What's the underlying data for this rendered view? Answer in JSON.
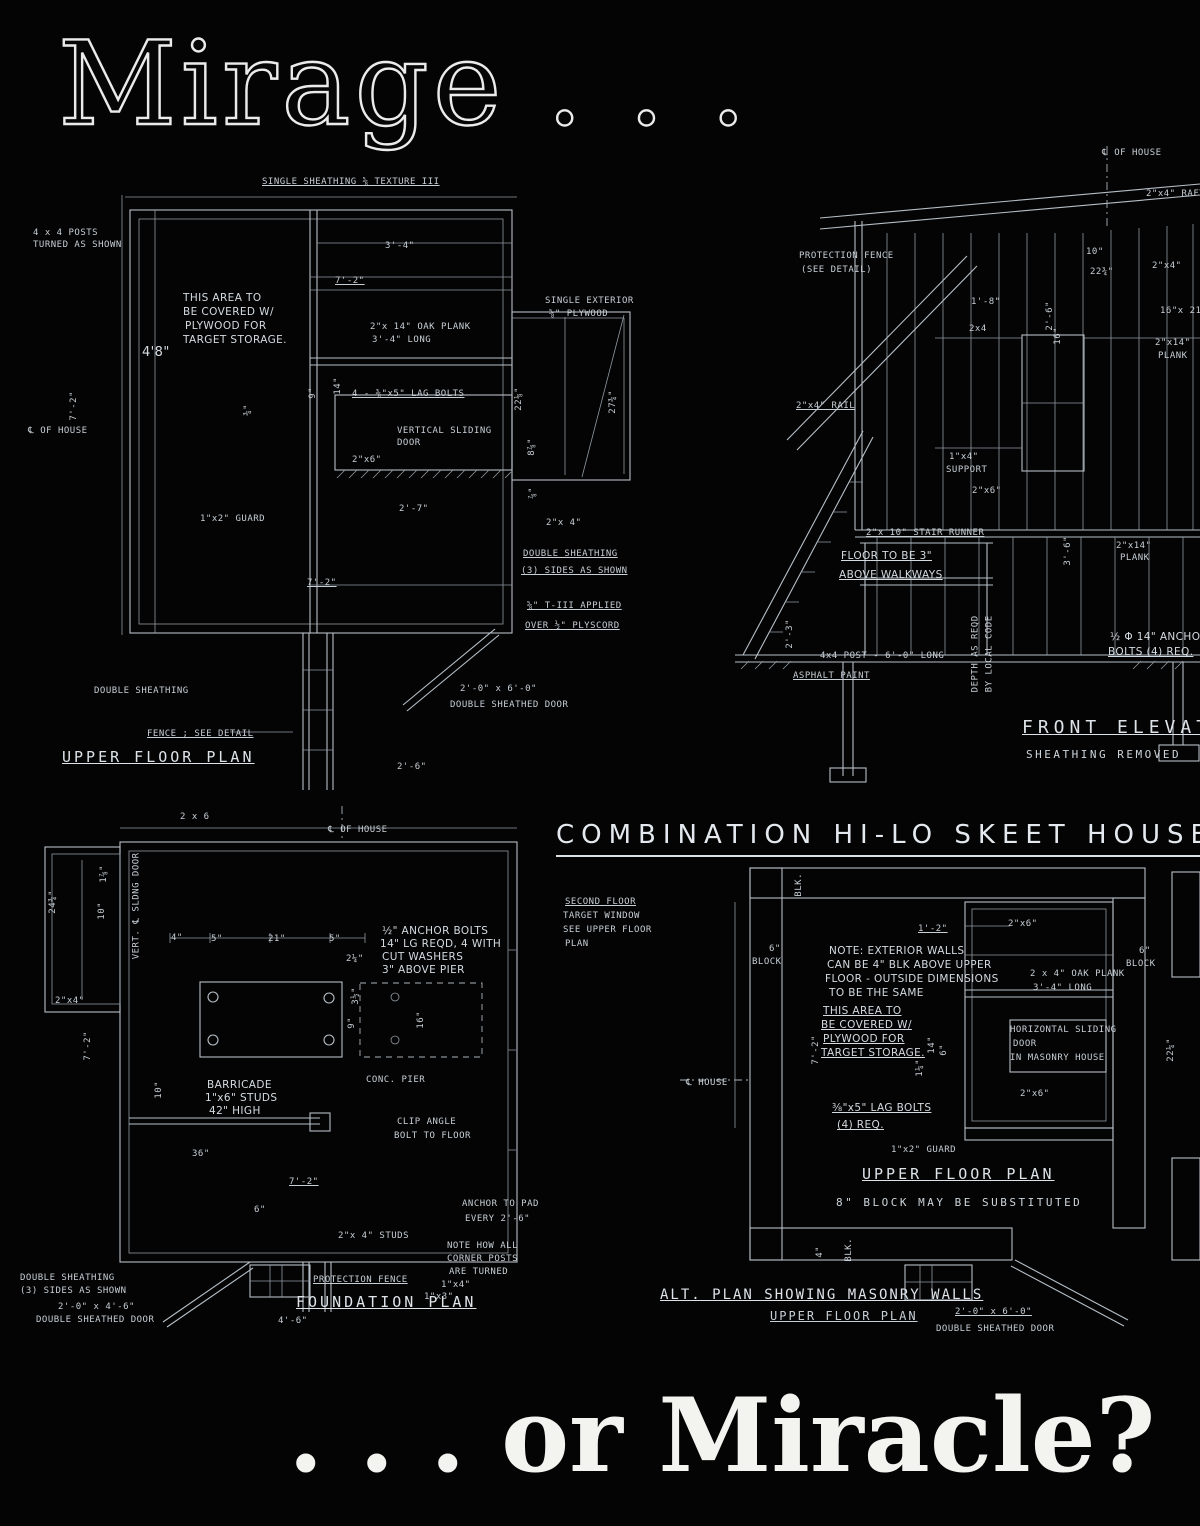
{
  "page": {
    "title_top": "Mirage . . .",
    "title_bottom": ". . . or Miracle?",
    "heading": "COMBINATION HI-LO SKEET HOUSE"
  },
  "panels": {
    "upper_plan": {
      "caption": "UPPER FLOOR PLAN",
      "annotations": [
        "SINGLE SHEATHING ⅝ TEXTURE III",
        "4 x 4 POSTS",
        "TURNED AS SHOWN",
        "THIS AREA TO",
        "BE COVERED W/",
        "PLYWOOD FOR",
        "TARGET STORAGE.",
        "3'-4\"",
        "7'-2\"",
        "4'8\"",
        "2\"x 14\" OAK PLANK",
        "3'-4\" LONG",
        "SINGLE EXTERIOR",
        "⅝\" PLYWOOD",
        "4 - ⅜\"x5\" LAG BOLTS",
        "9\"",
        "14\"",
        "7'-2\"",
        "¾\"",
        "℄ OF HOUSE",
        "22⅛\"",
        "27¾\"",
        "8⅞\"",
        "VERTICAL SLIDING",
        "DOOR",
        "2\"x6\"",
        "⅞\"",
        "2'-7\"",
        "1\"x2\" GUARD",
        "2\"x 4\"",
        "DOUBLE SHEATHING",
        "(3) SIDES AS SHOWN",
        "⅝\" T-III APPLIED",
        "OVER ½\" PLYSCORD",
        "7'-2\"",
        "DOUBLE SHEATHING",
        "2'-0\" x 6'-0\"",
        "DOUBLE SHEATHED DOOR",
        "FENCE ; SEE DETAIL",
        "2'-6\""
      ]
    },
    "elevation": {
      "caption": "FRONT ELEVATION",
      "subcaption": "SHEATHING REMOVED",
      "annotations": [
        "℄ OF HOUSE",
        "2\"x4\" RAFT",
        "PROTECTION FENCE",
        "(SEE DETAIL)",
        "10\"",
        "22¾\"",
        "2\"x4\"",
        "1'-8\"",
        "2x4",
        "2'-6\"",
        "16\"x 21¾\" D",
        "16\"",
        "2\"x14\"",
        "PLANK",
        "2\"x4\" RAIL",
        "1\"x4\"",
        "SUPPORT",
        "2\"x6\"",
        "2\"x 10\" STAIR RUNNER",
        "FLOOR TO BE 3\"",
        "ABOVE WALKWAYS",
        "3'-6\"",
        "2\"x14\"",
        "PLANK",
        "2'-3\"",
        "4x4 POST - 6'-0\" LONG",
        "ASPHALT PAINT",
        "DEPTH AS REQD",
        "BY LOCAL CODE",
        "½ Φ 14\" ANCHOR",
        "BOLTS (4) REQ."
      ]
    },
    "foundation": {
      "caption": "FOUNDATION PLAN",
      "annotations": [
        "2 x 6",
        "℄ OF HOUSE",
        "24¾\"",
        "1⅞\"",
        "10\"",
        "VERT. ℄ SLDNG DOOR",
        "2\"x4\"",
        "7'-2\"",
        "4\"",
        "5\"",
        "21\"",
        "5\"",
        "2¼\"",
        "½\" ANCHOR BOLTS",
        "14\" LG REQD, 4 WITH",
        "CUT WASHERS",
        "3\" ABOVE PIER",
        "3½\"",
        "9\"",
        "16\"",
        "CONC. PIER",
        "10\"",
        "BARRICADE",
        "1\"x6\" STUDS",
        "42\" HIGH",
        "CLIP ANGLE",
        "BOLT TO FLOOR",
        "36\"",
        "7'-2\"",
        "6\"",
        "2\"x 4\" STUDS",
        "ANCHOR TO PAD",
        "EVERY 2'-6\"",
        "NOTE HOW ALL",
        "CORNER POSTS",
        "ARE TURNED",
        "1\"x4\"",
        "1\"x3\"",
        "PROTECTION FENCE",
        "4'-6\"",
        "DOUBLE SHEATHING",
        "(3) SIDES AS SHOWN",
        "2'-0\" x 4'-6\"",
        "DOUBLE SHEATHED DOOR"
      ]
    },
    "alt_plan": {
      "caption": "UPPER FLOOR PLAN",
      "note": "8\" BLOCK MAY BE SUBSTITUTED",
      "caption2": "ALT. PLAN SHOWING MASONRY WALLS",
      "subcaption2": "UPPER FLOOR PLAN",
      "annotations": [
        "SECOND FLOOR",
        "TARGET WINDOW",
        "SEE UPPER FLOOR",
        "PLAN",
        "BLK.",
        "1'-2\"",
        "2\"x6\"",
        "6\"",
        "BLOCK",
        "6\"",
        "BLOCK",
        "NOTE: EXTERIOR WALLS",
        "CAN BE 4\" BLK ABOVE UPPER",
        "FLOOR - OUTSIDE DIMENSIONS",
        "TO BE THE SAME",
        "2 x 4\" OAK PLANK",
        "3'-4\" LONG",
        "THIS AREA TO",
        "BE COVERED W/",
        "PLYWOOD FOR",
        "TARGET STORAGE.",
        "HORIZONTAL SLIDING",
        "DOOR",
        "IN MASONRY HOUSE",
        "7'-2\"",
        "14\"",
        "1¼\"",
        "6\"",
        "22¼\"",
        "2\"x6\"",
        "⅜\"x5\" LAG BOLTS",
        "(4) REQ.",
        "1\"x2\" GUARD",
        "℄ HOUSE",
        "BLK.",
        "4\"",
        "2'-0\" x 6'-0\"",
        "DOUBLE SHEATHED DOOR"
      ]
    }
  }
}
